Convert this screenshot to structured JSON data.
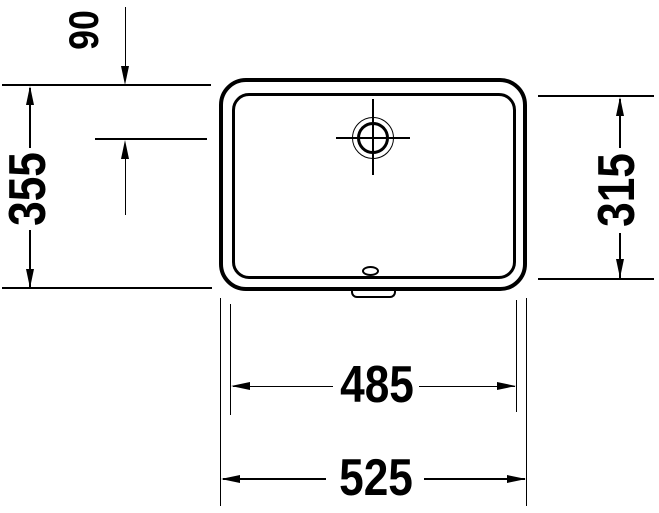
{
  "drawing": {
    "background_color": "#ffffff",
    "line_color": "#000000",
    "labels": {
      "dim_90": "90",
      "dim_355": "355",
      "dim_315": "315",
      "dim_485": "485",
      "dim_525": "525"
    }
  }
}
